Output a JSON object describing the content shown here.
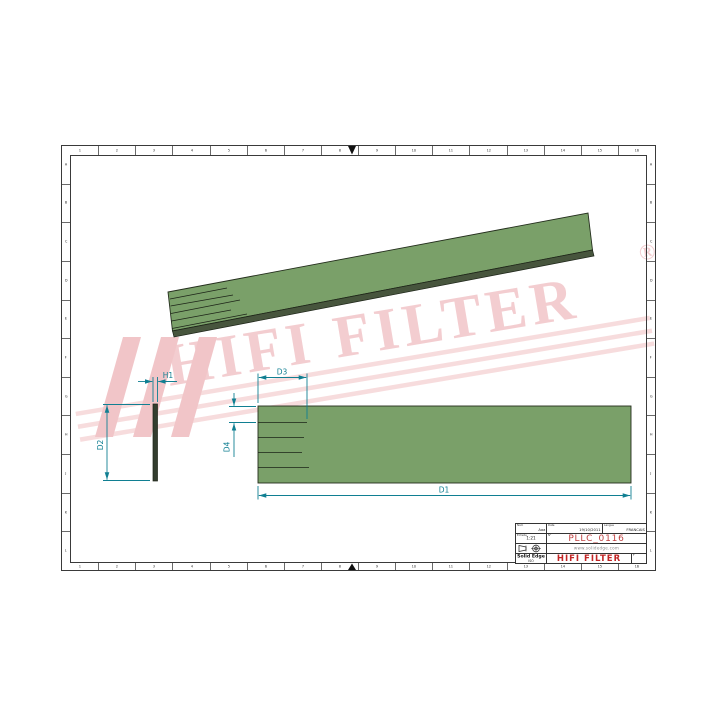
{
  "watermark": {
    "brand": "HIFI FILTER",
    "registered": "®",
    "pink_text": "#f3cdd0",
    "pink_stripe": "#f7dcdd",
    "pink_logo": "#f1c5c8"
  },
  "drawing": {
    "part_fill_green": "#7aa069",
    "part_edge_dark": "#242e1d",
    "dimension_color": "#107f92",
    "dimension_labels": {
      "h1": "H1",
      "d2": "D2",
      "d3": "D3",
      "d4": "D4",
      "d1": "D1"
    }
  },
  "title_block": {
    "name_label": "Nom",
    "name_value": "Aaa",
    "date_label": "Date",
    "date_value": "19/10/2011",
    "lang_label": "Langue",
    "lang_value": "FRANCAIS",
    "scale_label": "Echelle",
    "scale_value": "1:21",
    "part_label": "N°",
    "part_number": "PLLC_0116",
    "website": "www.solidedge.com",
    "cad_name": "Solid Edge",
    "cad_sub": "ISO",
    "brand": "HIFI FILTER",
    "sheet_label": "F"
  },
  "frame": {
    "zone_columns": [
      "1",
      "2",
      "3",
      "4",
      "5",
      "6",
      "7",
      "8",
      "9",
      "10",
      "11",
      "12",
      "13",
      "14",
      "15",
      "16"
    ],
    "zone_rows": [
      "A",
      "B",
      "C",
      "D",
      "E",
      "F",
      "G",
      "H",
      "J",
      "K",
      "L"
    ]
  }
}
